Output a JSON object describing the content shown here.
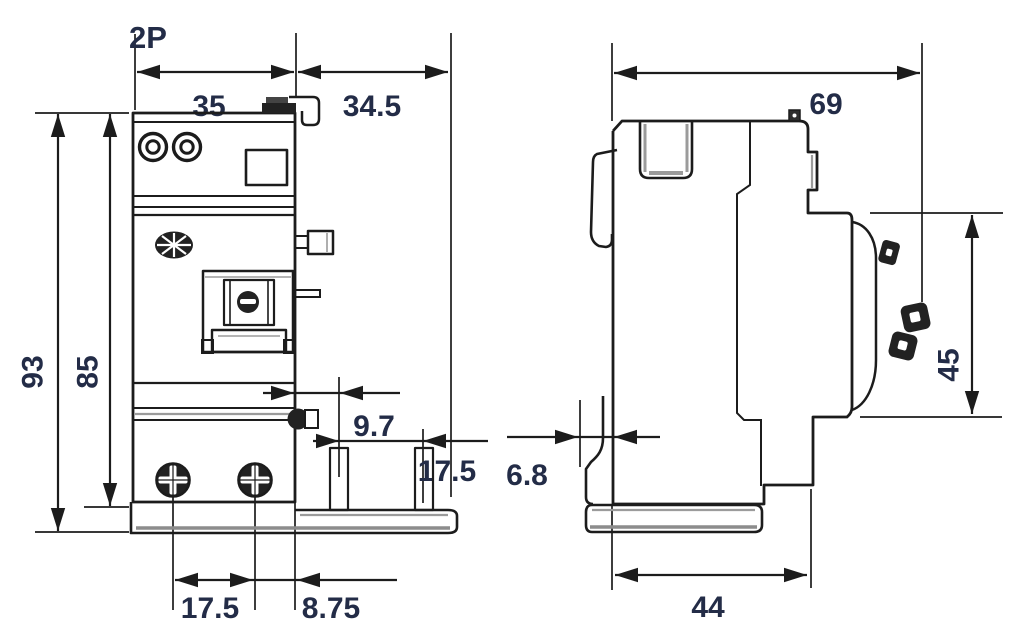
{
  "drawing": {
    "description": "dimensional-drawing-2-pole-residual-current-block",
    "pole_label": "2P",
    "front_view": {
      "width_mm": "35",
      "side_extension_mm": "34.5",
      "total_height_mm": "93",
      "body_height_mm": "85",
      "pin_offset_mm": "9.7",
      "pin_spacing_mm": "17.5",
      "terminal_spacing_mm": "17.5",
      "terminal_edge_offset_mm": "8.75"
    },
    "side_view": {
      "total_depth_mm": "69",
      "terminal_zone_height_mm": "45",
      "rail_clip_depth_mm": "6.8",
      "body_depth_mm": "44"
    },
    "colors": {
      "line": "#1c1c1c",
      "label": "#232c47",
      "shade": "#9b9b9b",
      "dark_fill": "#222222"
    }
  }
}
